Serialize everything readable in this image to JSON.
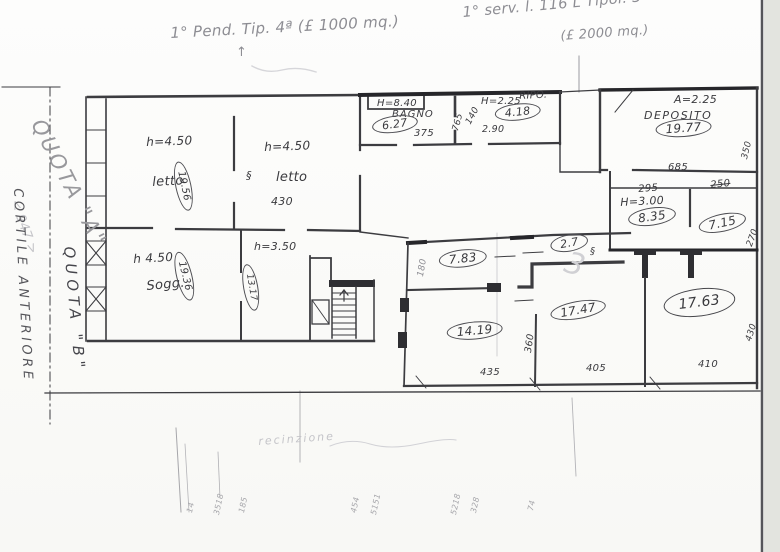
{
  "annotations": {
    "plot_left": "1° Pend. Tip. 4ª (£ 1000 mq.)",
    "arrow_up": "↑",
    "plot_right_1": "1° serv. l. 116 L Tipol. 3ª",
    "plot_right_2": "(£ 2000 mq.)",
    "quota_a": "QUOTA \"A\"",
    "quota_a_dim": "< 947 >",
    "cortile": "CORTILE ANTERIORE",
    "quota_b": "QUOTA \"B\"",
    "pencil_3": "3",
    "fence_note": "recinzione",
    "door_symbol": "§"
  },
  "rooms": {
    "letto_1": {
      "height": "h=4.50",
      "name": "letto",
      "area": "19.56"
    },
    "letto_2": {
      "height": "h=4.50",
      "name": "letto",
      "width": "430"
    },
    "bagno": {
      "height": "H=8.40",
      "name": "BAGNO",
      "area": "6.27",
      "width": "375"
    },
    "rip": {
      "height": "H=2.25",
      "name": "RIPO.",
      "area": "4.18",
      "width": "2.90"
    },
    "deposito": {
      "height": "A=2.25",
      "name": "DEPOSITO",
      "area": "19.77",
      "width": "685",
      "depth": "350"
    },
    "soggiorno": {
      "height": "h 4.50",
      "name": "Sogg.",
      "area": "19.36"
    },
    "room_3_50": {
      "height": "h=3.50",
      "area": "13.17"
    },
    "room_8_35": {
      "height": "H=3.00",
      "area": "8.35",
      "width": "295",
      "width_2": "250"
    },
    "room_7_15": {
      "area": "7.15",
      "depth": "270"
    },
    "room_7_83": {
      "area": "7.83",
      "depth": "180"
    },
    "room_2_7": {
      "area": "2.7"
    },
    "room_14_19": {
      "area": "14.19",
      "width": "435",
      "depth": "360"
    },
    "room_17_47": {
      "area": "17.47",
      "width": "405"
    },
    "room_17_63": {
      "area": "17.63",
      "width": "410",
      "depth": "430"
    }
  },
  "dims": {
    "bagno_rip_side": "765",
    "bagno_rip_diag": "140"
  },
  "bottom_ticks": [
    "14",
    "3518",
    "185",
    "454",
    "5151",
    "5218",
    "328",
    "74"
  ]
}
